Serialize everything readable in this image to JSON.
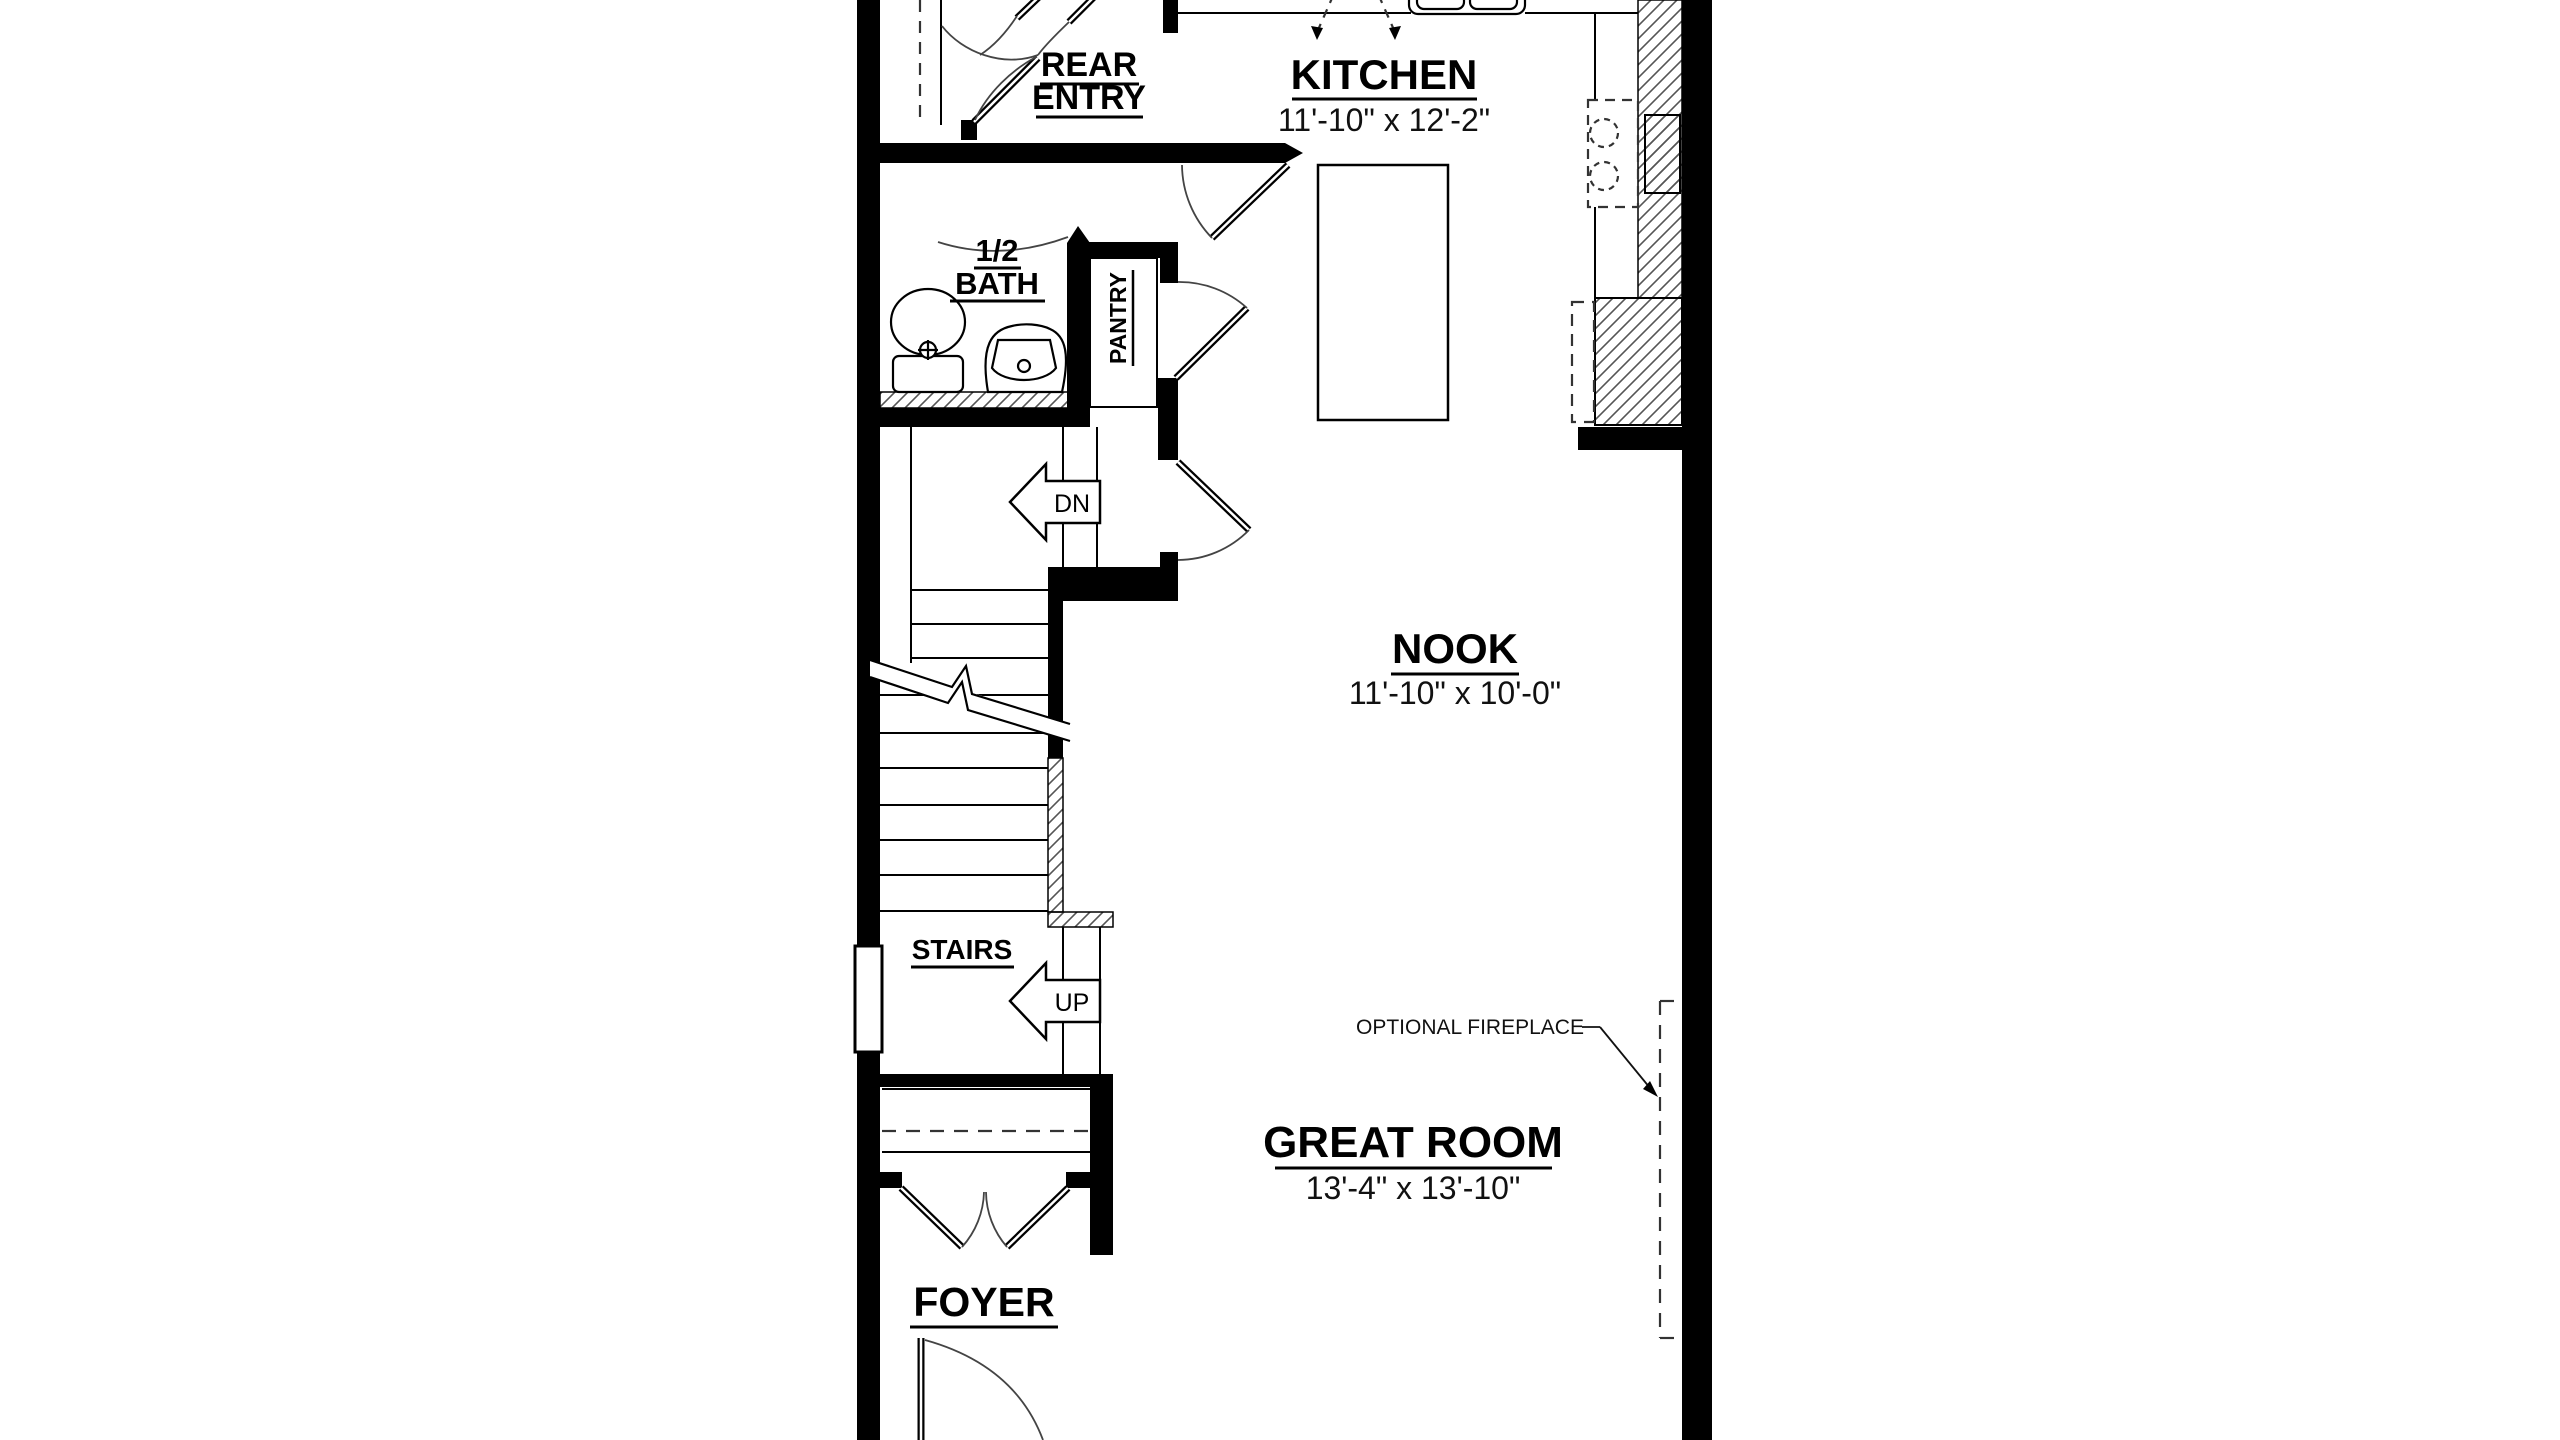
{
  "plan": {
    "rooms": {
      "rear_entry": {
        "line1": "REAR",
        "line2": "ENTRY"
      },
      "kitchen": {
        "name": "KITCHEN",
        "dims": "11'-10\" x 12'-2\""
      },
      "half_bath": {
        "line1": "1/2",
        "line2": "BATH"
      },
      "pantry": {
        "name": "PANTRY"
      },
      "nook": {
        "name": "NOOK",
        "dims": "11'-10\" x 10'-0\""
      },
      "stairs": {
        "name": "STAIRS"
      },
      "great_room": {
        "name": "GREAT ROOM",
        "dims": "13'-4\" x 13'-10\""
      },
      "foyer": {
        "name": "FOYER"
      }
    },
    "annotations": {
      "down": "DN",
      "up": "UP",
      "optional_fireplace": "OPTIONAL FIREPLACE"
    },
    "colors": {
      "wall": "#000000",
      "line": "#1a1a1a",
      "background": "#ffffff"
    }
  }
}
